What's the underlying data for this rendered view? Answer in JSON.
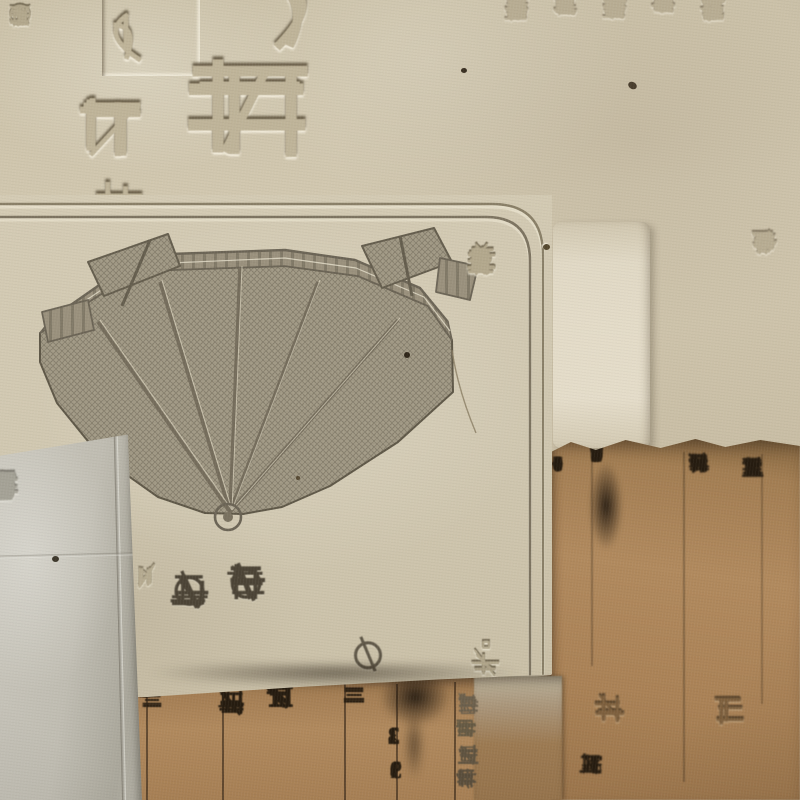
{
  "colors": {
    "paper_cream": "#cfc5ae",
    "panel_cream": "#d1c8b1",
    "paper_grey": "#bdbab0",
    "paper_brown": "#a8835a",
    "ink_dark": "#241b10",
    "ink_grey": "#4a4336",
    "emboss_shade": "#b4a98f",
    "illustration_grey": "#8f8878"
  },
  "top_sheet": {
    "edge_column": "れの",
    "left_column": "①控訴しても",
    "boxed_character": "も",
    "column_char_1": "再",
    "column_char_2": "扱",
    "large_character": "越",
    "partial_character": "う",
    "right_columns": [
      "の主張を",
      "おり謝と観念だ。今後の対応を判",
      "決内容を十分検討したうえで決め",
      "たい。認定申請者の協力なくして",
      "は促進が図られない面もあると理",
      "解と協力を要請"
    ]
  },
  "panel": {
    "side_column": "（眞甲道）。美しく栄えゆく",
    "side_boxed_char": "閲",
    "small_column": "〆切",
    "ink_column_1": "の梅園",
    "ink_column_2": "の薔藏",
    "ink_mark": "の"
  },
  "left_strip": {
    "column": "スケード賃の電具証明"
  },
  "embossed_block": {
    "rows": [
      "単店鋼",
      "業暑工",
      "首工日",
      "鋼変串"
    ]
  },
  "bottom_strip": {
    "marker_column": "一〇一",
    "price_1": "210",
    "price_2": "190",
    "bar_glyphs": "二三",
    "name_column_1": "上擶三棚",
    "name_column_2": "京居車中",
    "bar_glyphs_2": "三二",
    "price_3": "123",
    "price_4": "139"
  },
  "right_sheet": {
    "changes": [
      "+1",
      "0",
      "0",
      "+2",
      "0",
      "+1"
    ],
    "prices": [
      "42",
      "68",
      "64",
      "65",
      "69",
      "100",
      "100"
    ],
    "name_column_1": "鉄千鉄八幡鋼",
    "name_column_2": "三川鉄管日平",
    "embossed_char_1": "鋼",
    "embossed_char_2": "鉄",
    "bottom_row": "鉄管碼、52 +1"
  }
}
